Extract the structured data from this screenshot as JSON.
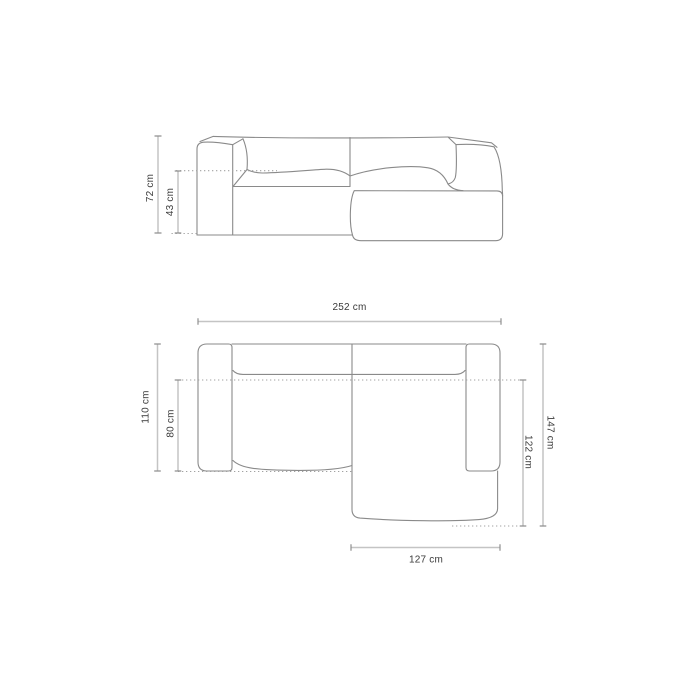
{
  "colors": {
    "background": "#ffffff",
    "outline": "#8a8a8a",
    "dimension_line": "#c4c4c4",
    "tick": "#8f8f8f",
    "dotted_line": "#a2a2a2",
    "label": "#3a3a3a"
  },
  "front_view": {
    "total_height": "72 cm",
    "seat_height": "43 cm"
  },
  "top_view": {
    "total_width": "252 cm",
    "sofa_depth": "110 cm",
    "seat_depth": "80 cm",
    "total_depth_with_chaise": "147 cm",
    "chaise_depth": "122 cm",
    "chaise_width": "127 cm"
  }
}
